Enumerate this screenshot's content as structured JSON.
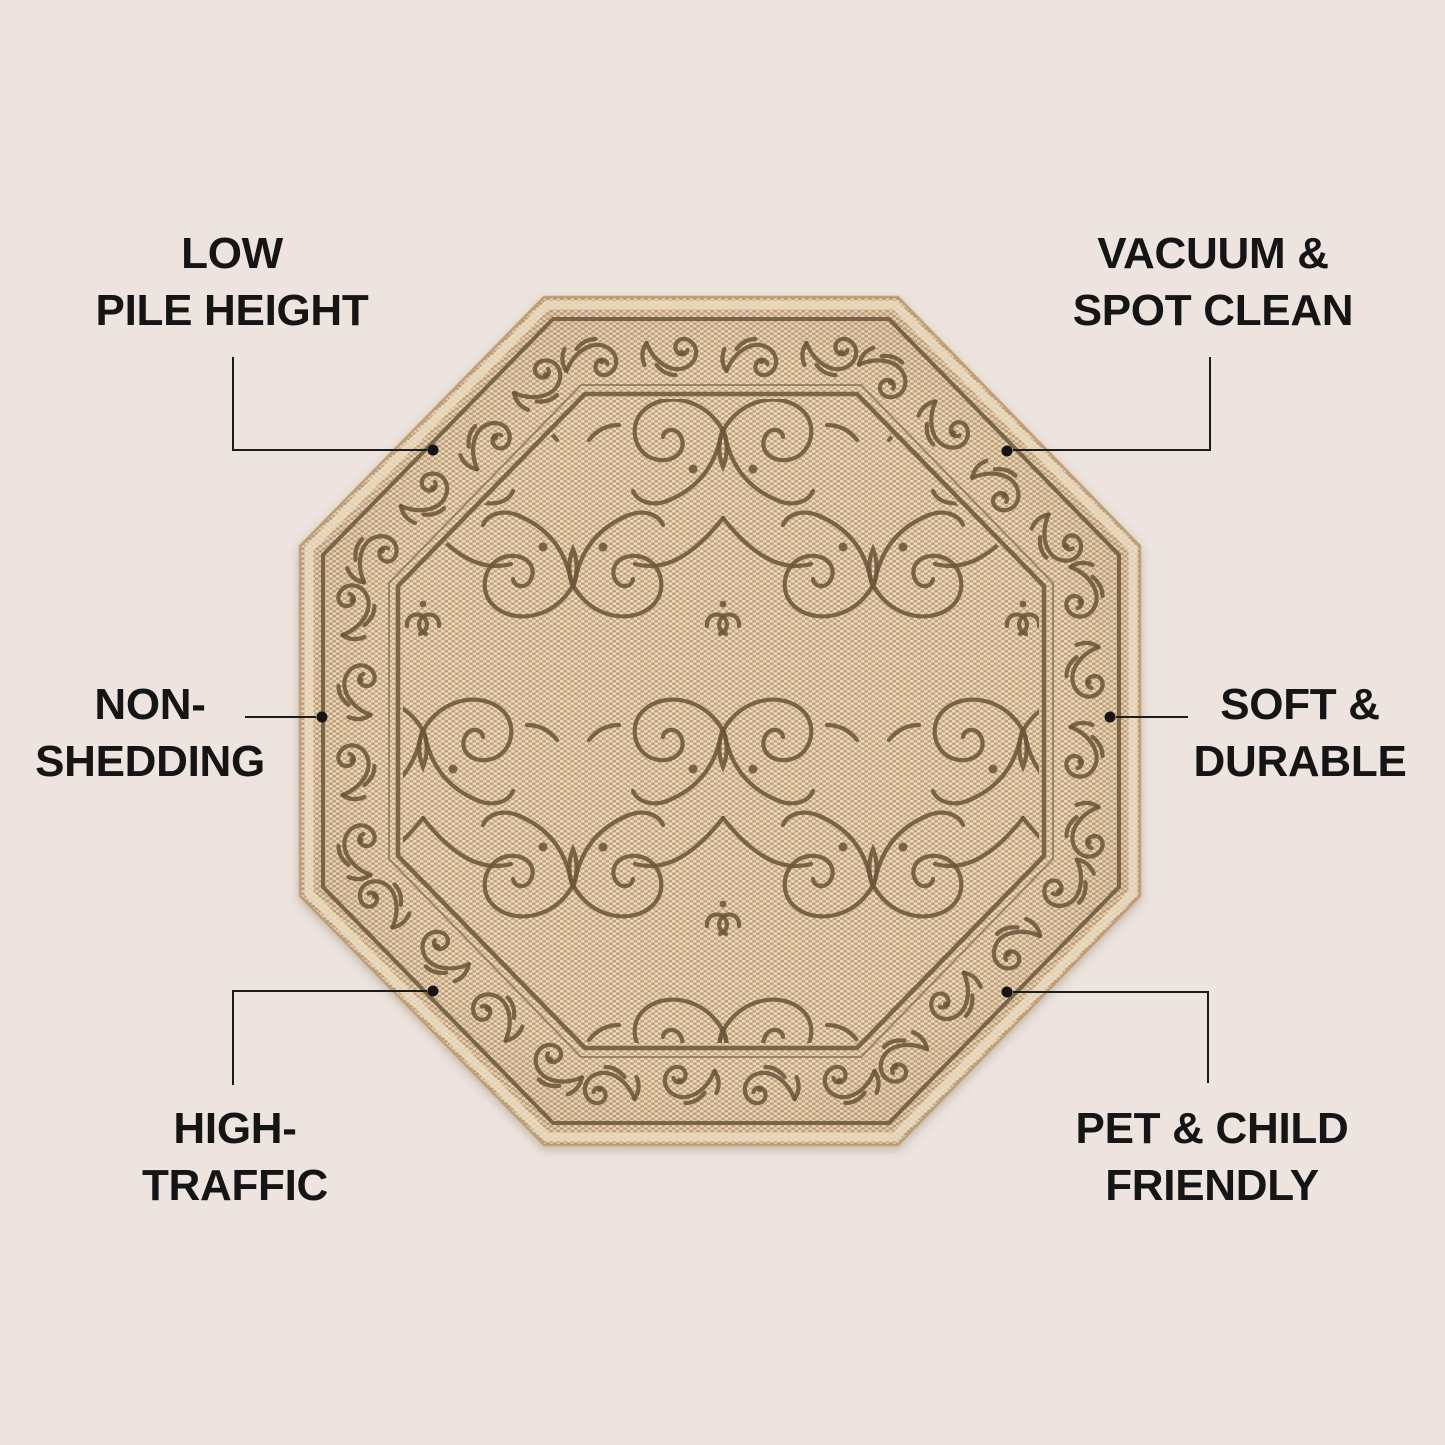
{
  "callouts": {
    "top_left": {
      "line1": "LOW",
      "line2": "PILE HEIGHT"
    },
    "top_right": {
      "line1": "VACUUM &",
      "line2": "SPOT CLEAN"
    },
    "mid_left": {
      "line1": "NON-",
      "line2": "SHEDDING"
    },
    "mid_right": {
      "line1": "SOFT &",
      "line2": "DURABLE"
    },
    "bottom_left": {
      "line1": "HIGH-",
      "line2": "TRAFFIC"
    },
    "bottom_right": {
      "line1": "PET & CHILD",
      "line2": "FRIENDLY"
    }
  },
  "colors": {
    "background": "#EDE4DF",
    "text": "#151515",
    "leader_line": "#1B1B1B",
    "callout_dot": "#151515",
    "rug_weave_base": "#D9BF9C",
    "rug_weave_light": "#ECDCC2",
    "rug_weave_dark": "#C19F78",
    "rug_pattern_brown": "#6B563A",
    "rug_frame_brown": "#6A5639",
    "rug_edge_tan": "#C2A277"
  }
}
